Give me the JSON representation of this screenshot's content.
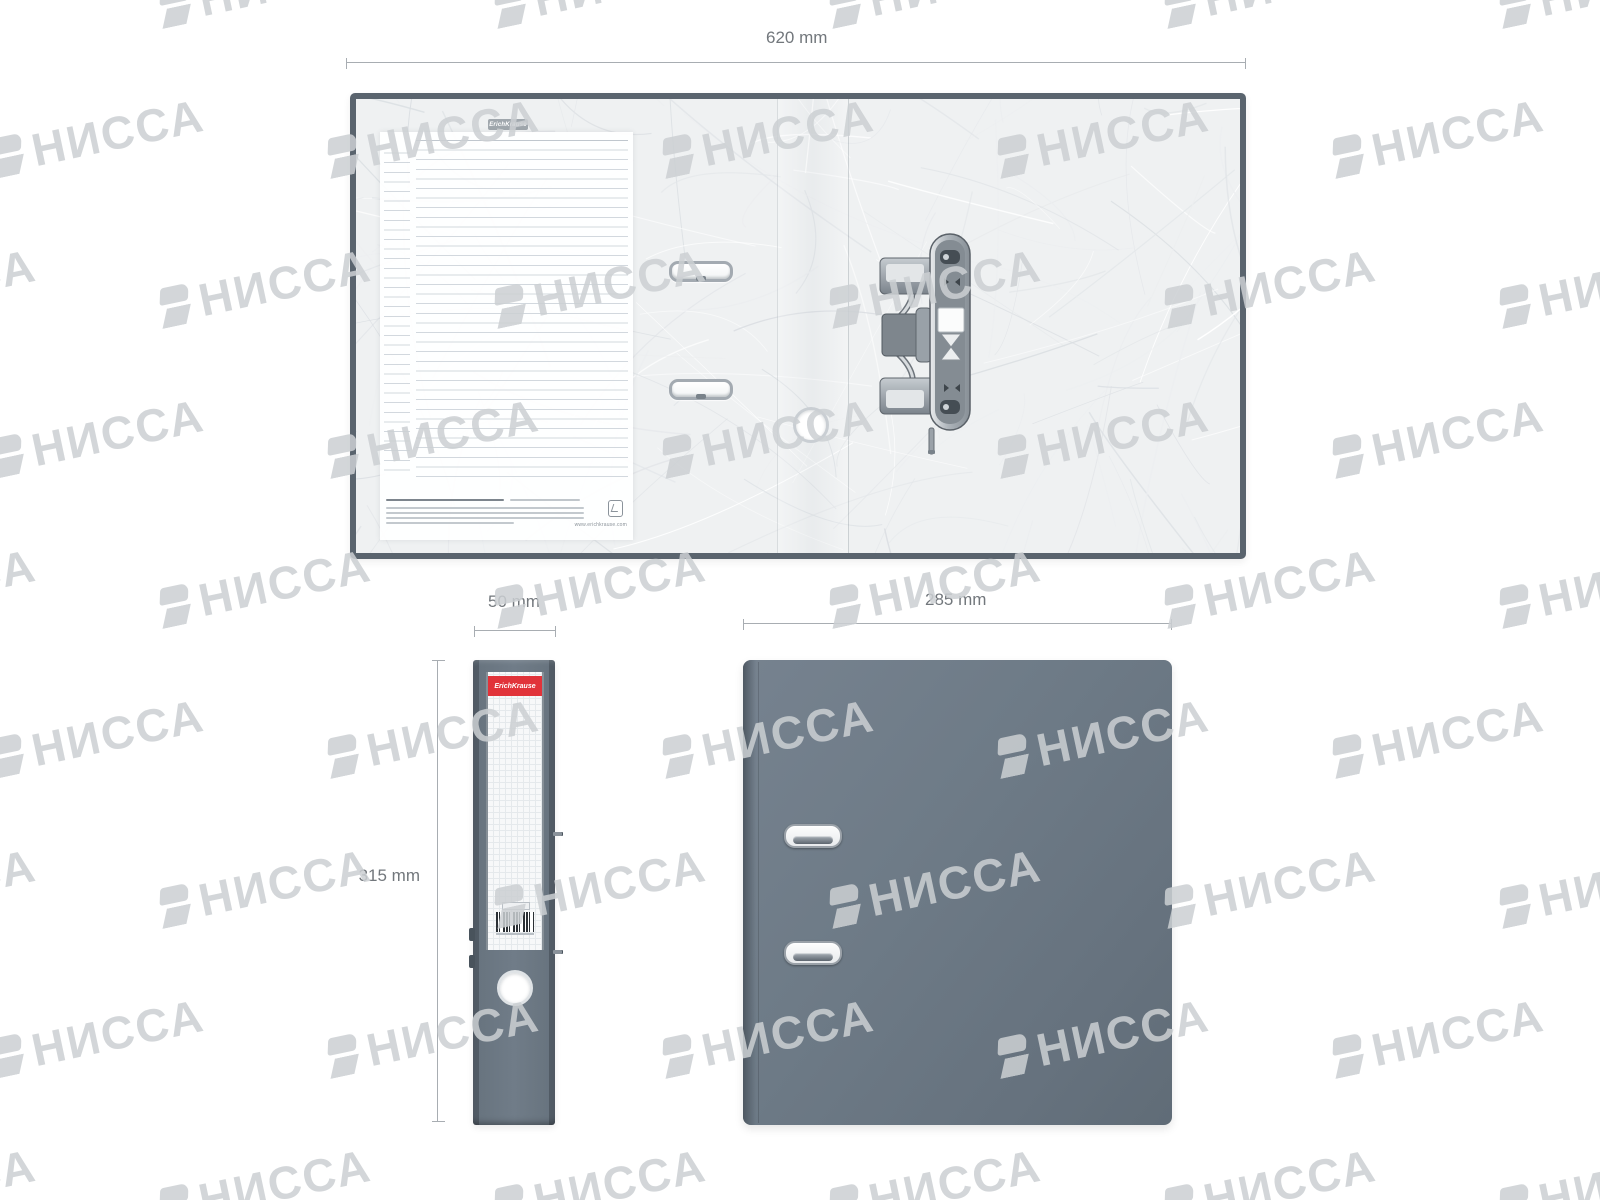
{
  "watermark": {
    "text": "НИССА"
  },
  "brand": {
    "name": "ErichKrause",
    "website": "www.erichkrause.com"
  },
  "dimensions": {
    "open_width": "620 mm",
    "spine_width": "50 mm",
    "height": "315 mm",
    "front_width": "285 mm"
  },
  "colors": {
    "cover_gray": "#6e7b87",
    "cover_edge": "#5a646e",
    "accent_red": "#e1333a",
    "dimension_line": "#a8adb2",
    "dimension_text": "#72777c",
    "metal": "#a3aab1",
    "watermark_gray": "#ccd0d3"
  }
}
